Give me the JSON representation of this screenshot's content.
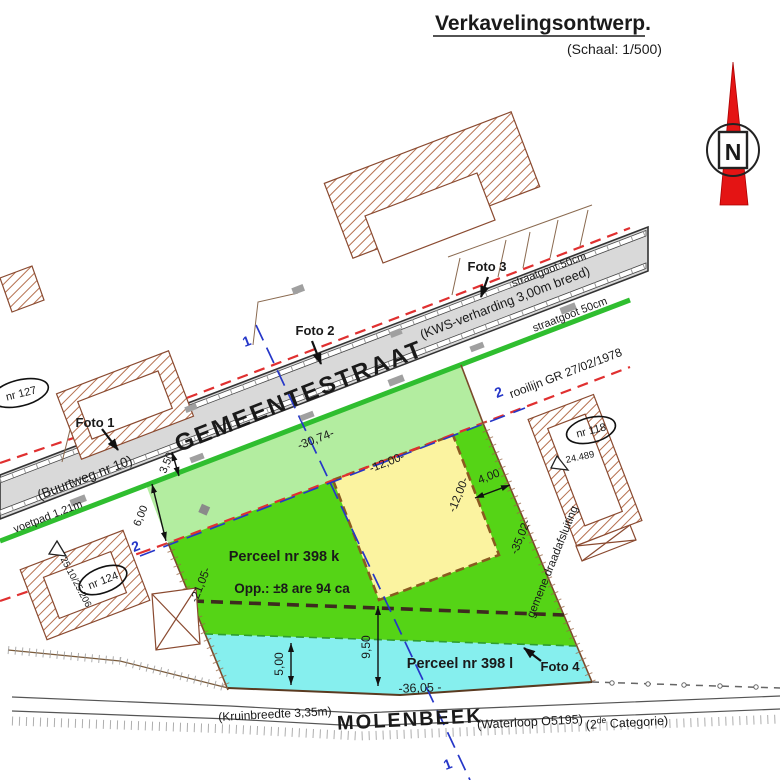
{
  "title": {
    "text": "Verkavelingsontwerp.",
    "scale": "(Schaal: 1/500)"
  },
  "north_label": "N",
  "street": {
    "name": "GEMEENTESTRAAT",
    "buurtweg": "(Buurtweg nr 10)",
    "surface": "(KWS-verharding 3,00m breed)",
    "gutter_top": "straatgoot 50cm",
    "gutter_bottom": "straatgoot 50cm",
    "sidewalk": "voetpad 1.21m"
  },
  "boundaries": {
    "rooilijn": "rooilijn GR 27/02/1978",
    "fence_right": "gemene draadafsluiting"
  },
  "parcels": {
    "k": {
      "name": "Perceel nr 398 k",
      "area": "Opp.: ±8 are 94 ca"
    },
    "l": {
      "name": "Perceel nr 398 l"
    }
  },
  "stream": {
    "name": "MOLENBEEK",
    "crest": "(Kruinbreedte 3,35m)",
    "waterway": "(Waterloop O5195)",
    "category_open": "(2",
    "category_sup": "de",
    "category_close": " Categorie)"
  },
  "photos": {
    "f1": "Foto 1",
    "f2": "Foto 2",
    "f3": "Foto 3",
    "f4": "Foto 4"
  },
  "houses": {
    "n127": "nr 127",
    "n124": "nr 124",
    "n118": "nr 118"
  },
  "benchmarks": {
    "b1": "25.10/25.206",
    "b2": "24.489"
  },
  "sections": {
    "s1": "1",
    "s2": "2"
  },
  "dimensions": {
    "front": "-30,74-",
    "box_top": "-12,00-",
    "box_right": "-12,00-",
    "side_gap": "4,00",
    "right": "-35,02-",
    "left": "-21,05-",
    "depth": "9,50",
    "bank": "5,00",
    "bottom": "-36,05 -",
    "berm": "3,50",
    "strip": "6,00"
  },
  "colors": {
    "parcel_green": "#55d416",
    "light_green": "#b3eda0",
    "building_zone_yellow": "#fbf3a0",
    "water_cyan": "#86efee",
    "street_grey": "#d9d9d9",
    "rooilijn_red": "#e03030",
    "section_blue": "#2637c8",
    "north_red": "#e41414",
    "hatch_brown": "#b5704f",
    "edge_green": "#2fbe2f"
  }
}
